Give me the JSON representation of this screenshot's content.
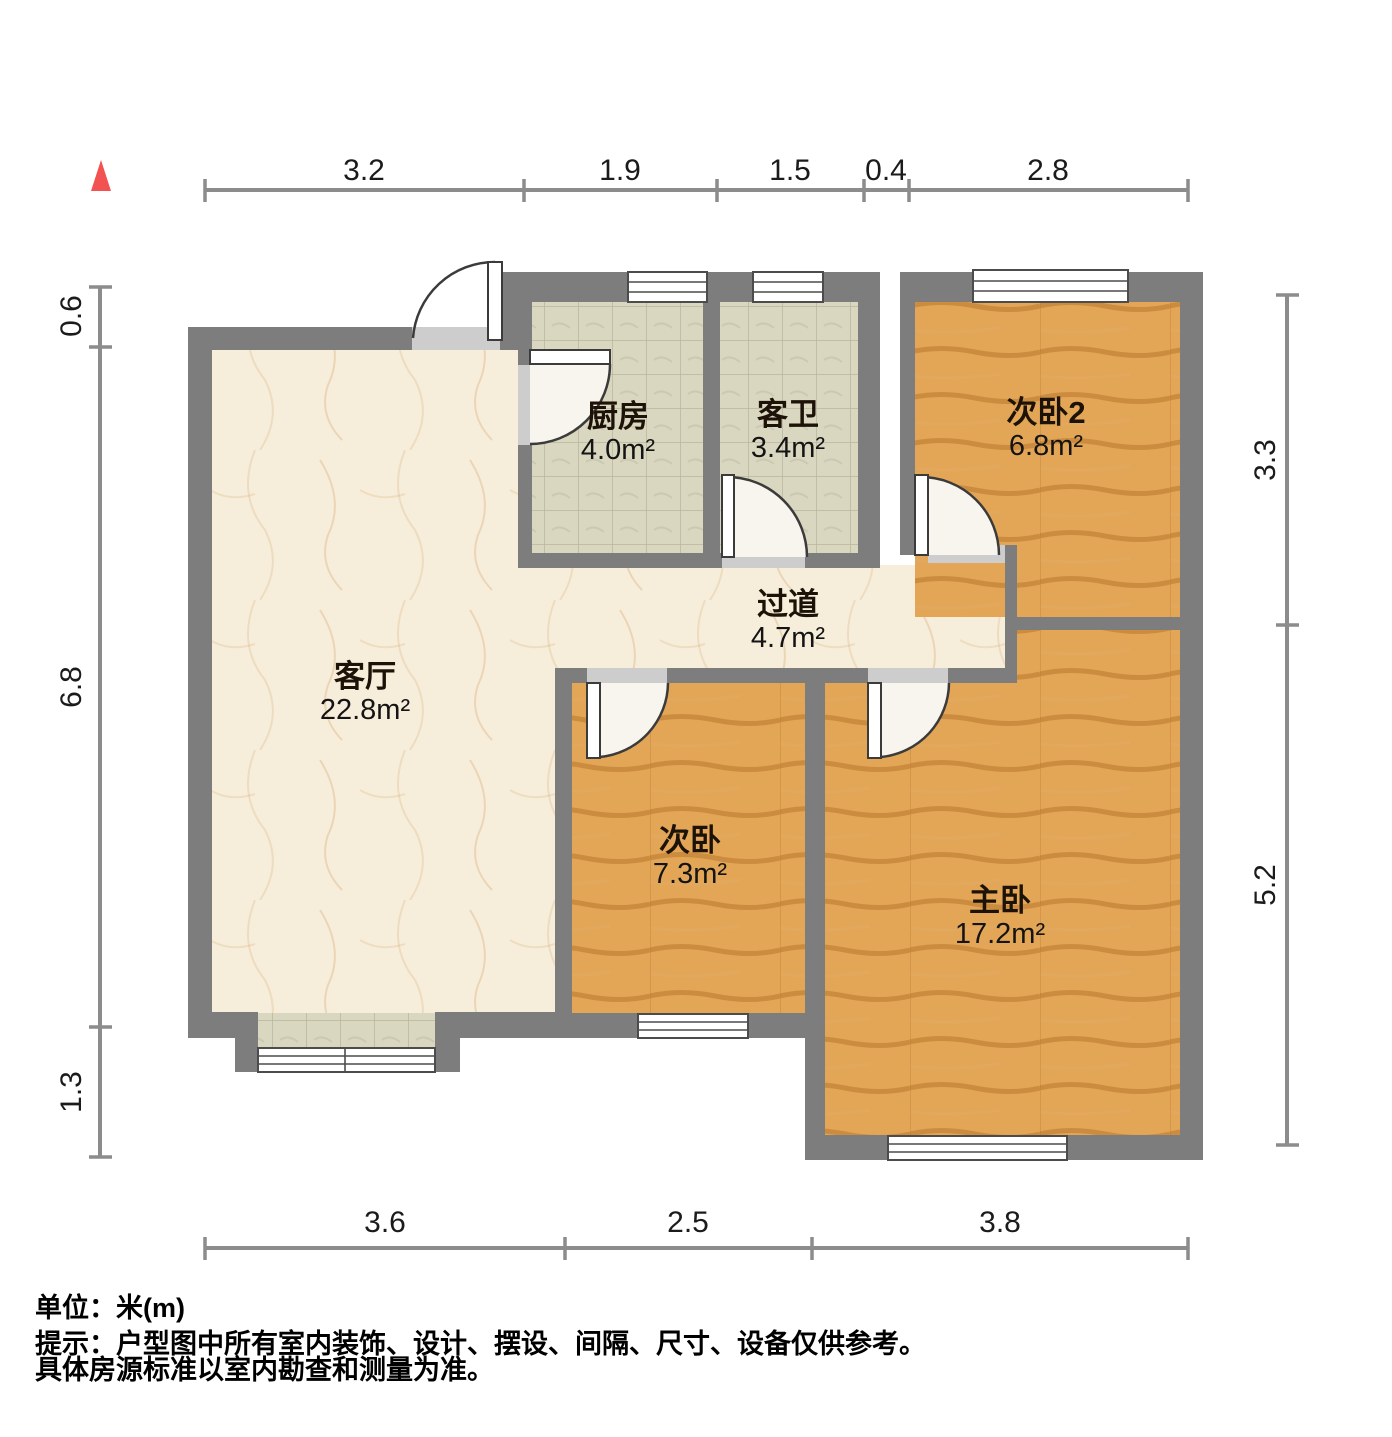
{
  "floor_plan": {
    "north_arrow_icon": "▲",
    "unit_label": "单位：米(m)",
    "tips": [
      "提示：户型图中所有室内装饰、设计、摆设、间隔、尺寸、设备仅供参考。",
      "具体房源标准以室内勘查和测量为准。"
    ],
    "rooms": {
      "kitchen": {
        "name": "厨房",
        "area": "4.0m²"
      },
      "guest_bath": {
        "name": "客卫",
        "area": "3.4m²"
      },
      "bedroom2": {
        "name": "次卧2",
        "area": "6.8m²"
      },
      "hallway": {
        "name": "过道",
        "area": "4.7m²"
      },
      "living_room": {
        "name": "客厅",
        "area": "22.8m²"
      },
      "bedroom": {
        "name": "次卧",
        "area": "7.3m²"
      },
      "master_bedroom": {
        "name": "主卧",
        "area": "17.2m²"
      }
    },
    "dimensions": {
      "top": [
        "3.2",
        "1.9",
        "1.5",
        "0.4",
        "2.8"
      ],
      "bottom": [
        "3.6",
        "2.5",
        "3.8"
      ],
      "left": [
        "0.6",
        "6.8",
        "1.3"
      ],
      "right": [
        "3.3",
        "5.2"
      ]
    },
    "colors": {
      "wall": "#7d7d7d",
      "threshold": "#cdcdcd",
      "wood": "#e2a656",
      "tile": "#d9d7c0",
      "marble": "#f6eedb",
      "dim-line": "#8c8c8c",
      "accent": "#f25352",
      "text": "#111111"
    }
  }
}
